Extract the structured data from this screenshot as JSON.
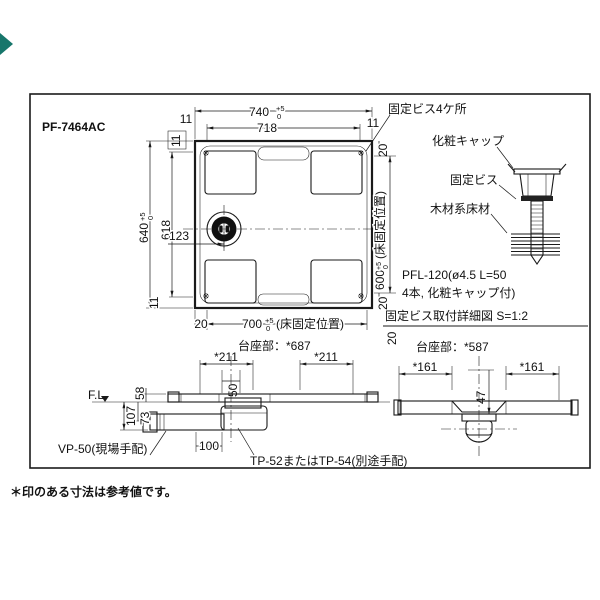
{
  "title": "PF-7464AC",
  "note": "＊印のある寸法は参考値です。",
  "tol": {
    "plus": "+5",
    "zero": "0"
  },
  "plan": {
    "w740": "740",
    "w718": "718",
    "h640": "640",
    "h618": "618",
    "floor_w": "700",
    "floor_h": "600",
    "floor_label": "(床固定位置)",
    "m11": "11",
    "g20": "20",
    "drain_offset": "123",
    "base": "台座部：*687"
  },
  "detail": {
    "screws4": "固定ビス4ケ所",
    "cap": "化粧キャップ",
    "screw": "固定ビス",
    "floor": "木材系床材",
    "spec1": "PFL-120(ø4.5 L=50",
    "spec2": "4本, 化粧キャップ付)",
    "caption": "固定ビス取付詳細図 S=1:2",
    "base": "台座部：*587"
  },
  "front": {
    "fl": "F.L",
    "rim": "58",
    "depth_total": "107",
    "depth_center": "73",
    "w211": "*211",
    "w50": "50",
    "pipe": "VP-50(現場手配)",
    "t100": "100",
    "trap": "TP-52またはTP-54(別途手配)"
  },
  "side": {
    "w161": "*161",
    "h47": "47"
  },
  "colors": {
    "line": "#1a1a1a",
    "accent": "#17766b"
  }
}
